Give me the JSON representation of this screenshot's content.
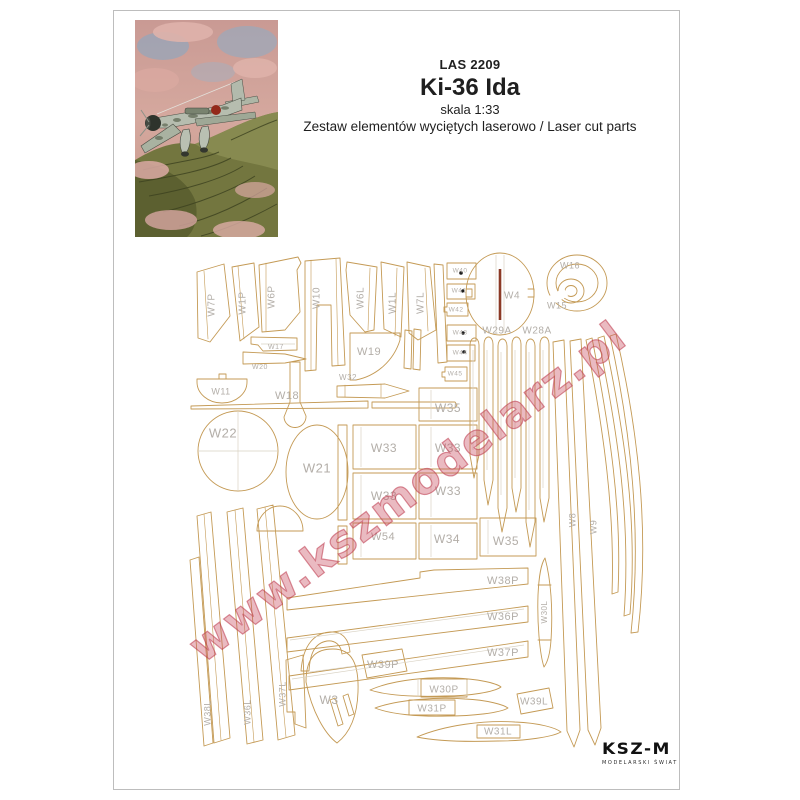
{
  "header": {
    "code": "LAS 2209",
    "title": "Ki-36 Ida",
    "scale": "skala 1:33",
    "subtitle": "Zestaw elementów wyciętych laserowo / Laser cut parts"
  },
  "watermark": "www.kszmodelarz.pl",
  "logo": {
    "name": "KSZ-M",
    "tagline": "MODELARSKI ŚWIAT"
  },
  "colors": {
    "cut_line": "#c49a55",
    "internal_line": "#d9d2c3",
    "part_label": "#b3aea8",
    "watermark_pink": "#cb5264",
    "engrave_red": "#8c3a26",
    "frame_gray": "#bdbdbd"
  },
  "parts": [
    {
      "t": "W7P",
      "x": 212,
      "y": 305,
      "r": -90,
      "s": 10
    },
    {
      "t": "W1P",
      "x": 243,
      "y": 303,
      "r": -90,
      "s": 10
    },
    {
      "t": "W6P",
      "x": 272,
      "y": 297,
      "r": -90,
      "s": 10
    },
    {
      "t": "W10",
      "x": 317,
      "y": 298,
      "r": -90,
      "s": 10
    },
    {
      "t": "W6L",
      "x": 361,
      "y": 298,
      "r": -90,
      "s": 10
    },
    {
      "t": "W1L",
      "x": 393,
      "y": 303,
      "r": -90,
      "s": 10
    },
    {
      "t": "W7L",
      "x": 421,
      "y": 303,
      "r": -90,
      "s": 10
    },
    {
      "t": "W40",
      "x": 460,
      "y": 271,
      "r": 0,
      "s": 6.5
    },
    {
      "t": "W41",
      "x": 459,
      "y": 291,
      "r": 0,
      "s": 6.5
    },
    {
      "t": "W42",
      "x": 456,
      "y": 310,
      "r": 0,
      "s": 6.5
    },
    {
      "t": "W43",
      "x": 460,
      "y": 333,
      "r": 0,
      "s": 6.5
    },
    {
      "t": "W44",
      "x": 460,
      "y": 353,
      "r": 0,
      "s": 6.5
    },
    {
      "t": "W45",
      "x": 455,
      "y": 374,
      "r": 0,
      "s": 6.5
    },
    {
      "t": "W4",
      "x": 512,
      "y": 296,
      "r": 0,
      "s": 10
    },
    {
      "t": "W16",
      "x": 570,
      "y": 266,
      "r": 0,
      "s": 9
    },
    {
      "t": "W15",
      "x": 557,
      "y": 306,
      "r": 0,
      "s": 9
    },
    {
      "t": "W29A",
      "x": 497,
      "y": 331,
      "r": 0,
      "s": 10
    },
    {
      "t": "W28A",
      "x": 537,
      "y": 331,
      "r": 0,
      "s": 10
    },
    {
      "t": "W17",
      "x": 276,
      "y": 347,
      "r": 0,
      "s": 7
    },
    {
      "t": "W20",
      "x": 260,
      "y": 367,
      "r": 0,
      "s": 7
    },
    {
      "t": "W19",
      "x": 369,
      "y": 352,
      "r": 0,
      "s": 11
    },
    {
      "t": "W11",
      "x": 221,
      "y": 392,
      "r": 0,
      "s": 9
    },
    {
      "t": "W18",
      "x": 287,
      "y": 396,
      "r": 0,
      "s": 11
    },
    {
      "t": "W32",
      "x": 348,
      "y": 378,
      "r": 0,
      "s": 8
    },
    {
      "t": "W22",
      "x": 223,
      "y": 434,
      "r": 0,
      "s": 13
    },
    {
      "t": "W21",
      "x": 317,
      "y": 469,
      "r": 0,
      "s": 13
    },
    {
      "t": "W35",
      "x": 448,
      "y": 409,
      "r": 0,
      "s": 12
    },
    {
      "t": "W33",
      "x": 384,
      "y": 449,
      "r": 0,
      "s": 12
    },
    {
      "t": "W33",
      "x": 448,
      "y": 449,
      "r": 0,
      "s": 12
    },
    {
      "t": "W33",
      "x": 384,
      "y": 497,
      "r": 0,
      "s": 12
    },
    {
      "t": "W33",
      "x": 448,
      "y": 492,
      "r": 0,
      "s": 12
    },
    {
      "t": "W54",
      "x": 383,
      "y": 537,
      "r": 0,
      "s": 11
    },
    {
      "t": "W34",
      "x": 447,
      "y": 540,
      "r": 0,
      "s": 12
    },
    {
      "t": "W35",
      "x": 506,
      "y": 542,
      "r": 0,
      "s": 12
    },
    {
      "t": "W38P",
      "x": 503,
      "y": 581,
      "r": 0,
      "s": 11
    },
    {
      "t": "W36P",
      "x": 503,
      "y": 617,
      "r": 0,
      "s": 11
    },
    {
      "t": "W37P",
      "x": 503,
      "y": 653,
      "r": 0,
      "s": 11
    },
    {
      "t": "W39P",
      "x": 383,
      "y": 665,
      "r": 0,
      "s": 11
    },
    {
      "t": "W39L",
      "x": 534,
      "y": 702,
      "r": 0,
      "s": 10
    },
    {
      "t": "W30P",
      "x": 444,
      "y": 690,
      "r": 0,
      "s": 10
    },
    {
      "t": "W31P",
      "x": 432,
      "y": 709,
      "r": 0,
      "s": 10
    },
    {
      "t": "W31L",
      "x": 498,
      "y": 732,
      "r": 0,
      "s": 10
    },
    {
      "t": "W30L",
      "x": 545,
      "y": 612,
      "r": -90,
      "s": 8
    },
    {
      "t": "W38L",
      "x": 208,
      "y": 713,
      "r": -90,
      "s": 9
    },
    {
      "t": "W36L",
      "x": 248,
      "y": 712,
      "r": -90,
      "s": 9
    },
    {
      "t": "W37L",
      "x": 283,
      "y": 694,
      "r": -90,
      "s": 9
    },
    {
      "t": "W8",
      "x": 573,
      "y": 520,
      "r": -90,
      "s": 9
    },
    {
      "t": "W9",
      "x": 594,
      "y": 527,
      "r": -90,
      "s": 9
    },
    {
      "t": "W3",
      "x": 329,
      "y": 701,
      "r": 0,
      "s": 12
    }
  ]
}
